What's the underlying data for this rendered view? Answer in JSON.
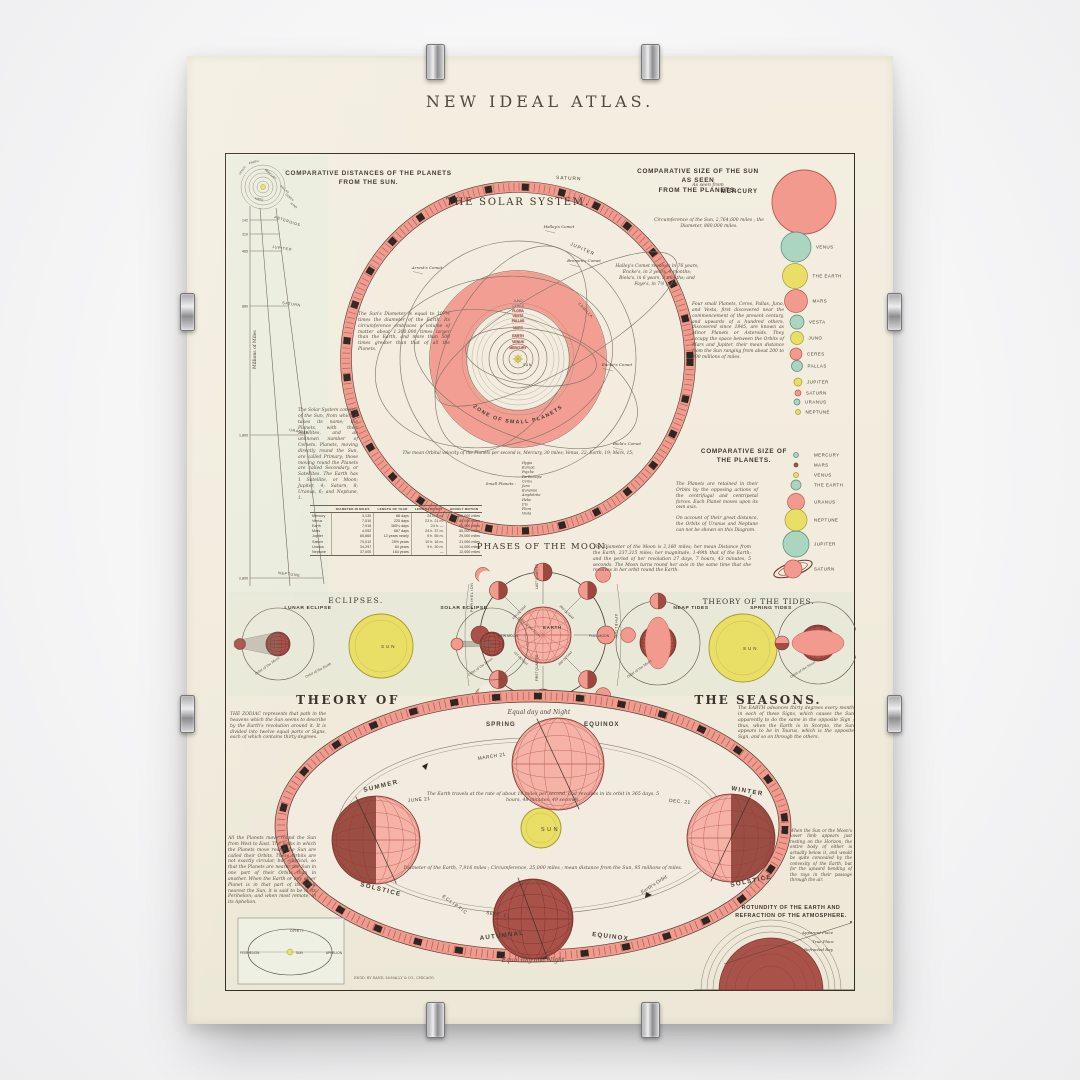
{
  "colors": {
    "paper": "#f1ecdf",
    "panel": "#e9ecdd",
    "ink": "#453c33",
    "salmon": "#f29a8e",
    "salmon_light": "#f6b2a7",
    "salmon_dark": "#b95a4d",
    "maroon": "#a8524a",
    "maroon_dark": "#7c372f",
    "teal": "#abd4c1",
    "teal_dark": "#55897a",
    "yellow": "#eadf66",
    "yellow_dark": "#a59a35"
  },
  "poster": {
    "title": "NEW IDEAL ATLAS.",
    "publisher": "ENGD. BY RAND, McNALLY & CO., CHICAGO."
  },
  "fan": {
    "heading1": "COMPARATIVE DISTANCES OF THE PLANETS",
    "heading2": "FROM THE SUN.",
    "axis": "Millions of Miles",
    "ticks": [
      {
        "v": "142",
        "y": 66
      },
      {
        "v": "310",
        "y": 80
      },
      {
        "v": "485",
        "y": 97
      },
      {
        "v": "880",
        "y": 152
      },
      {
        "v": "1,800",
        "y": 281
      },
      {
        "v": "2,800",
        "y": 424
      }
    ],
    "labels": [
      {
        "t": "ASTEROIDS",
        "x": 48,
        "y": 64,
        "r": 18
      },
      {
        "t": "JUPITER",
        "x": 46,
        "y": 94,
        "r": 8
      },
      {
        "t": "SATURN",
        "x": 56,
        "y": 150,
        "r": 8
      },
      {
        "t": "URANUS",
        "x": 63,
        "y": 277,
        "r": 9
      },
      {
        "t": "NEPTUNE",
        "x": 52,
        "y": 420,
        "r": 7
      }
    ],
    "apex": [
      {
        "t": "EARTH",
        "x": 28,
        "y": 9,
        "r": -14
      },
      {
        "t": "VENUS",
        "x": 17,
        "y": 17,
        "r": -55
      },
      {
        "t": "MERCURY",
        "x": 44,
        "y": 21,
        "r": 42
      },
      {
        "t": "MARS",
        "x": 33,
        "y": 46,
        "r": 12
      },
      {
        "t": "PALLAS",
        "x": 58,
        "y": 36,
        "r": 40
      },
      {
        "t": "CERES",
        "x": 63,
        "y": 44,
        "r": 40
      },
      {
        "t": "JUNO",
        "x": 67,
        "y": 52,
        "r": 40
      }
    ]
  },
  "solar": {
    "title": "THE SOLAR SYSTEM.",
    "saturn": "SATURN",
    "jupiter": "JUPITER",
    "zone": "ZONE  OF  SMALL  PLANETS",
    "camilla": "CAMILLA",
    "sun": "SUN",
    "orbit_names": [
      {
        "name": "MERCURY",
        "r": 9
      },
      {
        "name": "VENUS",
        "r": 15
      },
      {
        "name": "EARTH",
        "r": 21
      },
      {
        "name": "MARS",
        "r": 29
      },
      {
        "name": "PALLAS",
        "r": 36
      },
      {
        "name": "VESTA",
        "r": 41
      },
      {
        "name": "FLORA",
        "r": 46
      },
      {
        "name": "CERES",
        "r": 51
      },
      {
        "name": "JUNO",
        "r": 56
      }
    ],
    "comets": [
      {
        "name": "Halley's Comet",
        "x": 333,
        "y": 74
      },
      {
        "name": "Brorsen's Comet",
        "x": 358,
        "y": 108
      },
      {
        "name": "Arrest's Comet",
        "x": 201,
        "y": 115
      },
      {
        "name": "Encke's Comet",
        "x": 391,
        "y": 212
      },
      {
        "name": "Biela's Comet",
        "x": 401,
        "y": 291
      }
    ],
    "notes": {
      "sun_note": "The Sun's Diameter is equal to 107½ times the diameter of the Earth.  Its circumference embraces a volume of matter about 1,300,000 times larger than the Earth, and more than 500 times greater than that of all the Planets.",
      "margin_note": "The Solar System consists of the Sun, from which it takes its name; the Planets, with their Satellites, and an unknown number of Comets.  Planets, moving directly round the Sun, are called Primary; those moving round the Planets are called Secondary, or Satellites.  The Earth has 1 Satellite, or Moon; Jupiter, 4; Saturn, 8; Uranus, 6; and Neptune, 1.",
      "minor_note": "Four small Planets, Ceres, Pallas, Juno, and Vesta, first discovered near the commencement of the present century, and upwards of a hundred others, discovered since 1845, are known as Minor Planets or Asteroids.  They occupy the space between the Orbits of Mars and Jupiter, their mean distance from the Sun ranging from about 200 to 300 millions of miles.",
      "uranus_note": "On account of their great distance, the Orbits of Uranus and Neptune can not be shown on this Diagram.",
      "comet_note": "Halley's Comet revolves in 76 years; Encke's, in 3 years, 4 months; Biela's, in 6 years, 9 months; and Faye's, in 7½ years.",
      "velocity_note": "The mean Orbital velocity of the Planets per second is, Mercury, 30 miles; Venus, 22; Earth, 19; Mars, 15;"
    },
    "small_planets_label": "Small Planets :",
    "small_planets": [
      "Hygia",
      "Europa",
      "Psyche",
      "Parthenope",
      "Ceres",
      "Juno",
      "Eunomia",
      "Amphitrite",
      "Hebe",
      "Iris",
      "Flora",
      "Vesta"
    ]
  },
  "sun_sizes": {
    "heading1": "COMPARATIVE SIZE OF THE SUN AS SEEN",
    "heading2": "FROM THE PLANETS.",
    "as_seen": "As seen from",
    "mercury": "MERCURY",
    "circ_note": "Circumference of the Sun, 2,764,600 miles ; the Diameter, 880,000 miles.",
    "items": [
      {
        "label": "VENUS",
        "color": "teal",
        "cx": 570,
        "cy": 93,
        "r": 15
      },
      {
        "label": "THE EARTH",
        "color": "yellow",
        "cx": 569,
        "cy": 122,
        "r": 12.5
      },
      {
        "label": "MARS",
        "color": "salmon",
        "cx": 570,
        "cy": 147,
        "r": 11.5
      },
      {
        "label": "VESTA",
        "color": "teal",
        "cx": 571,
        "cy": 168,
        "r": 7
      },
      {
        "label": "JUNO",
        "color": "yellow",
        "cx": 571,
        "cy": 184,
        "r": 6.5
      },
      {
        "label": "CERES",
        "color": "salmon",
        "cx": 570,
        "cy": 200,
        "r": 6
      },
      {
        "label": "PALLAS",
        "color": "teal",
        "cx": 571,
        "cy": 212,
        "r": 5.5
      },
      {
        "label": "JUPITER",
        "color": "yellow",
        "cx": 572,
        "cy": 228,
        "r": 4
      },
      {
        "label": "SATURN",
        "color": "salmon",
        "cx": 572,
        "cy": 239,
        "r": 3
      },
      {
        "label": "URANUS",
        "color": "teal",
        "cx": 571,
        "cy": 248,
        "r": 3
      },
      {
        "label": "NEPTUNE",
        "color": "yellow",
        "cx": 572,
        "cy": 258,
        "r": 2.5
      }
    ]
  },
  "planet_sizes": {
    "heading1": "COMPARATIVE SIZE OF",
    "heading2": "THE PLANETS.",
    "note": "The Planets are retained in their Orbits by the opposing actions of the centrifugal and centripetal forces.  Each Planet moves upon its own axis.",
    "items": [
      {
        "label": "MERCURY",
        "color": "teal",
        "cx": 570,
        "cy": 301,
        "r": 2.5
      },
      {
        "label": "MARS",
        "color": "maroon",
        "cx": 570,
        "cy": 311,
        "r": 2
      },
      {
        "label": "VENUS",
        "color": "yellow",
        "cx": 570,
        "cy": 321,
        "r": 2.5
      },
      {
        "label": "THE EARTH",
        "color": "teal",
        "cx": 570,
        "cy": 331,
        "r": 5
      },
      {
        "label": "URANUS",
        "color": "salmon",
        "cx": 570,
        "cy": 348,
        "r": 8.5
      },
      {
        "label": "NEPTUNE",
        "color": "yellow",
        "cx": 570,
        "cy": 366,
        "r": 11
      },
      {
        "label": "JUPITER",
        "color": "teal",
        "cx": 570,
        "cy": 390,
        "r": 13
      },
      {
        "label": "SATURN",
        "color": "salmon",
        "cx": 567,
        "cy": 415,
        "r": 9,
        "ringed": true
      }
    ]
  },
  "table": {
    "headers": [
      "",
      "DIAMETER IN MILES",
      "LENGTH OF YEAR",
      "LENGTH OF DAY",
      "HOURLY MOTION"
    ],
    "rows": [
      [
        "Mercury",
        "3,130",
        "88 days",
        "24 h. 5 m.",
        "100,000 miles"
      ],
      [
        "Venus",
        "7,510",
        "225 days",
        "23 h. 21 m.",
        "80,000 miles"
      ],
      [
        "Earth",
        "7,916",
        "365¼ days",
        "24 h. —",
        "65,000 miles"
      ],
      [
        "Mars",
        "4,092",
        "687 days",
        "24 h. 37 m.",
        "55,000 miles"
      ],
      [
        "Jupiter",
        "85,860",
        "12 years nearly",
        "9 h. 55 m.",
        "29,000 miles"
      ],
      [
        "Saturn",
        "70,012",
        "29½ years",
        "10 h. 16 m.",
        "21,000 miles"
      ],
      [
        "Uranus",
        "34,297",
        "84 years",
        "9 h. 30 m.",
        "14,000 miles"
      ],
      [
        "Neptune",
        "37,000",
        "164 years",
        "—",
        "12,000 miles"
      ]
    ]
  },
  "moon": {
    "heading": "PHASES OF THE MOON.",
    "note": "The Diameter of the Moon is 2,160 miles; her mean Distance from the Earth, 237,315 miles; her magnitude, 1-49th that of the Earth; and the period of her revolution 27 days, 7 hours, 43 minutes, 5 seconds.  The Moon turns round her axis in the same time that she revolves in her orbit round the Earth.",
    "earth": "EARTH",
    "new_moon": "NEW MOON",
    "full_moon": "FULL MOON",
    "first_q": "FIRST QUARTER",
    "last_q": "LAST QUARTER",
    "perihelion": "PERIHELION",
    "aphelion": "APHELION",
    "spokes": [
      {
        "t": "4TH OCTANT",
        "x": 294,
        "y": 459,
        "r": -45
      },
      {
        "t": "3RD OCTANT",
        "x": 340,
        "y": 459,
        "r": 45
      },
      {
        "t": "1ST OCTANT",
        "x": 294,
        "y": 505,
        "r": 45
      },
      {
        "t": "2ND OCTANT",
        "x": 340,
        "y": 505,
        "r": -45
      }
    ]
  },
  "eclipses": {
    "heading": "ECLIPSES.",
    "lunar": "LUNAR ECLIPSE",
    "solar": "SOLAR ECLIPSE",
    "sun": "SUN",
    "orbit_moon": "Orbit of the Moon",
    "orbit_earth": "Orbit of the Earth"
  },
  "tides": {
    "heading": "THEORY OF THE TIDES.",
    "neap": "NEAP TIDES",
    "spring": "SPRING TIDES",
    "sun": "SUN",
    "orbit_moon": "Orbit of the Moon"
  },
  "seasons": {
    "heading1": "THEORY  OF",
    "heading2": "THE  SEASONS.",
    "equal_top": "Equal day and Night",
    "equal_bottom": "Equal day and Night",
    "spring": "SPRING",
    "equinox_sp": "EQUINOX",
    "march": "MARCH 21",
    "summer": "SUMMER",
    "solstice_l": "SOLSTICE",
    "june": "JUNE 21",
    "winter": "WINTER",
    "solstice_r": "SOLSTICE",
    "dec": "DEC. 21",
    "autumnal": "AUTUMNAL",
    "equinox_au": "EQUINOX",
    "sept": "SEPT. 21",
    "sun": "SUN",
    "ecliptic": "ECLIPTIC",
    "earths_orbit": "Earth's Orbit",
    "travel_note": "The Earth travels at the rate of about 19 miles per second, and revolves in its orbit in 365 days, 5 hours, 48 minutes, 49 seconds.",
    "diameter_note": "Diameter of the Earth, 7,916 miles ;  Circumference, 25,000 miles ;  mean distance from the Sun, 95 millions of miles.",
    "zodiac_note": "THE ZODIAC represents that path in the heavens which the Sun seems to describe by the Earth's revolution around it.  It is divided into twelve equal parts or Signs, each of which contains thirty degrees.",
    "orbits_note": "All the Planets move round the Sun from West to East.  The paths in which the Planets move round the Sun are called their Orbits.  These Orbits are not exactly circular, but elliptical, so that the Planets are nearer the Sun in one part of their Orbits than in another.  When the Earth or any other Planet is in that part of its Orbit nearest the Sun, it is said to be in its Perihelion; and when most remote, in its Aphelion.",
    "signs_note": "The EARTH advances thirty degrees every month in each of these Signs, which causes the Sun apparently to do the same in the opposite Sign ; thus, when the Earth is in Scorpio, the Sun appears to be in Taurus, which is the opposite Sign, and so on through the others.",
    "refraction_note": "When the Sun or the Moon's lower limb appears just resting on the Horizon, the entire body of either is actually below it, and would be quite concealed by the convexity of the Earth, but for the upward bending of the rays in their passage through the air."
  },
  "orbit_box": {
    "orbit": "ORBIT",
    "perihelion": "PERIHELION",
    "aphelion": "APHELION",
    "sun": "SUN"
  },
  "rotundity": {
    "heading1": "ROTUNDITY OF THE EARTH AND",
    "heading2": "REFRACTION OF THE ATMOSPHERE.",
    "apparent": "Apparent Place",
    "true_place": "True Place",
    "refracted": "Refracted Ray"
  }
}
